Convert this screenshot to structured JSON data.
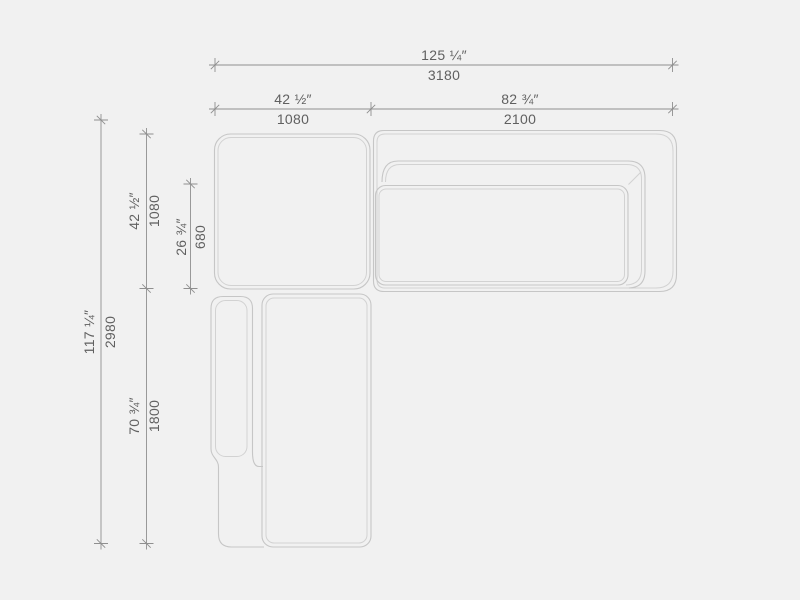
{
  "drawing": {
    "type": "sofa-top-view-dimension-drawing",
    "dimensions": {
      "overall_width": {
        "inches": "125 ¼″",
        "mm": "3180"
      },
      "section_left_width": {
        "inches": "42 ½″",
        "mm": "1080"
      },
      "section_right_width": {
        "inches": "82 ¾″",
        "mm": "2100"
      },
      "overall_depth": {
        "inches": "117 ¼″",
        "mm": "2980"
      },
      "upper_section_depth": {
        "inches": "42 ½″",
        "mm": "1080"
      },
      "seat_depth": {
        "inches": "26 ¾″",
        "mm": "680"
      },
      "chaise_length": {
        "inches": "70 ¾″",
        "mm": "1800"
      }
    },
    "colors": {
      "background": "#f1f1f1",
      "outline": "#c6c6c6",
      "outline_inner": "#d2d2d2",
      "dimension_line": "#8f8f8f",
      "label_text": "#606060"
    }
  }
}
